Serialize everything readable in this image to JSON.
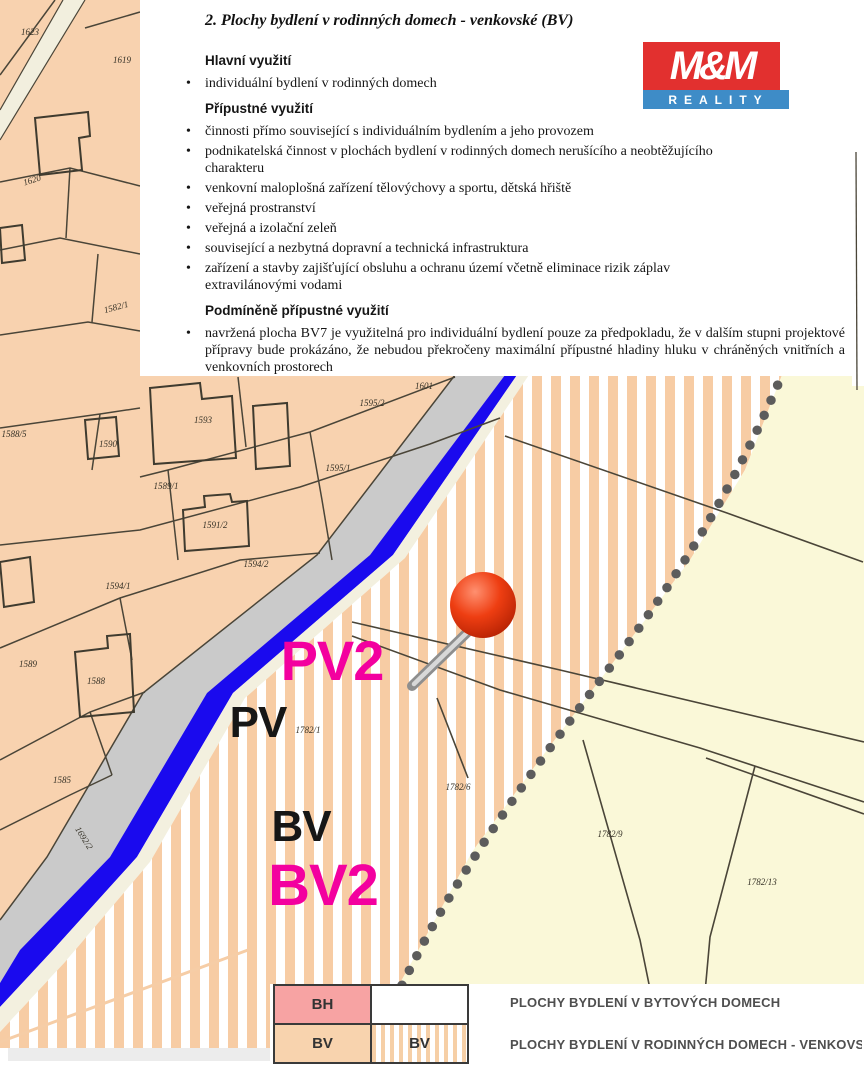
{
  "document": {
    "title": "2. Plochy bydlení v rodinných domech - venkovské (BV)",
    "blocks": [
      {
        "type": "heading",
        "text": "Hlavní využití"
      },
      {
        "type": "bullet",
        "text": "individuální bydlení v rodinných domech"
      },
      {
        "type": "heading",
        "text": "Přípustné využití"
      },
      {
        "type": "bullet",
        "text": "činnosti přímo související s individuálním bydlením a jeho provozem"
      },
      {
        "type": "bullet",
        "text": "podnikatelská činnost v plochách bydlení v rodinných domech nerušícího a neobtěžujícího charakteru"
      },
      {
        "type": "bullet",
        "text": "venkovní maloplošná zařízení tělovýchovy a sportu, dětská hřiště"
      },
      {
        "type": "bullet",
        "text": "veřejná prostranství"
      },
      {
        "type": "bullet",
        "text": "veřejná a izolační zeleň"
      },
      {
        "type": "bullet",
        "text": "související a nezbytná dopravní a technická infrastruktura"
      },
      {
        "type": "bullet",
        "text": "zařízení a stavby zajišťující obsluhu a ochranu území včetně eliminace rizik záplav extravilánovými vodami"
      },
      {
        "type": "heading",
        "text": "Podmíněně přípustné využití"
      },
      {
        "type": "bullet justify",
        "text": "navržená plocha BV7 je využitelná pro individuální bydlení pouze za předpokladu, že v dalším stupni projektové přípravy bude prokázáno, že nebudou překročeny maximální přípustné hladiny hluku v chráněných vnitřních a venkovních prostorech"
      }
    ]
  },
  "logo": {
    "line1": "M&M",
    "line2": "REALITY",
    "red": "#E2302F",
    "blue": "#3E8CC7"
  },
  "map": {
    "zone_labels": [
      {
        "t": "PV2",
        "x": 332,
        "y": 661,
        "size": 56,
        "color": "#F3009F"
      },
      {
        "t": "PV",
        "x": 258,
        "y": 723,
        "size": 44,
        "color": "#161616"
      },
      {
        "t": "BV",
        "x": 301,
        "y": 827,
        "size": 44,
        "color": "#161616"
      },
      {
        "t": "BV2",
        "x": 323,
        "y": 886,
        "size": 58,
        "color": "#F3009F"
      }
    ],
    "parcel_labels": [
      {
        "t": "1623",
        "x": 30,
        "y": 32
      },
      {
        "t": "1619",
        "x": 122,
        "y": 60
      },
      {
        "t": "1620",
        "x": 32,
        "y": 180,
        "r": -18
      },
      {
        "t": "1582/1",
        "x": 116,
        "y": 307,
        "r": -15
      },
      {
        "t": "1601",
        "x": 424,
        "y": 386
      },
      {
        "t": "1595/2",
        "x": 372,
        "y": 403
      },
      {
        "t": "1593",
        "x": 203,
        "y": 420
      },
      {
        "t": "1590",
        "x": 108,
        "y": 444
      },
      {
        "t": "1588/5",
        "x": 14,
        "y": 434
      },
      {
        "t": "1595/1",
        "x": 338,
        "y": 468
      },
      {
        "t": "1589/1",
        "x": 166,
        "y": 486
      },
      {
        "t": "1591/2",
        "x": 215,
        "y": 525
      },
      {
        "t": "1594/2",
        "x": 256,
        "y": 564
      },
      {
        "t": "1594/1",
        "x": 118,
        "y": 586
      },
      {
        "t": "1589",
        "x": 28,
        "y": 664
      },
      {
        "t": "1588",
        "x": 96,
        "y": 681
      },
      {
        "t": "1585",
        "x": 62,
        "y": 780
      },
      {
        "t": "1692/2",
        "x": 84,
        "y": 838,
        "r": 58
      },
      {
        "t": "1782/1",
        "x": 308,
        "y": 730
      },
      {
        "t": "1782/6",
        "x": 458,
        "y": 787
      },
      {
        "t": "1782/9",
        "x": 610,
        "y": 834
      },
      {
        "t": "1782/13",
        "x": 762,
        "y": 882
      }
    ],
    "colors": {
      "parcel_base": "#F8D2AF",
      "stripe": "#F7CCA4",
      "yellow_zone": "#FAF8D8",
      "road_gray": "#CACACA",
      "road_blue": "#1A0AEE",
      "boundary_dots": "#5C5C5C",
      "zone_magenta": "#F3009F",
      "pin_red": "#E9330B",
      "line": "#4A4538"
    }
  },
  "legend": {
    "rows": [
      {
        "code": "BH",
        "sample": "",
        "label": "PLOCHY BYDLENÍ V BYTOVÝCH DOMECH"
      },
      {
        "code": "BV",
        "sample": "BV",
        "label": "PLOCHY BYDLENÍ V RODINNÝCH DOMECH - VENKOVSKÉ -"
      }
    ]
  }
}
